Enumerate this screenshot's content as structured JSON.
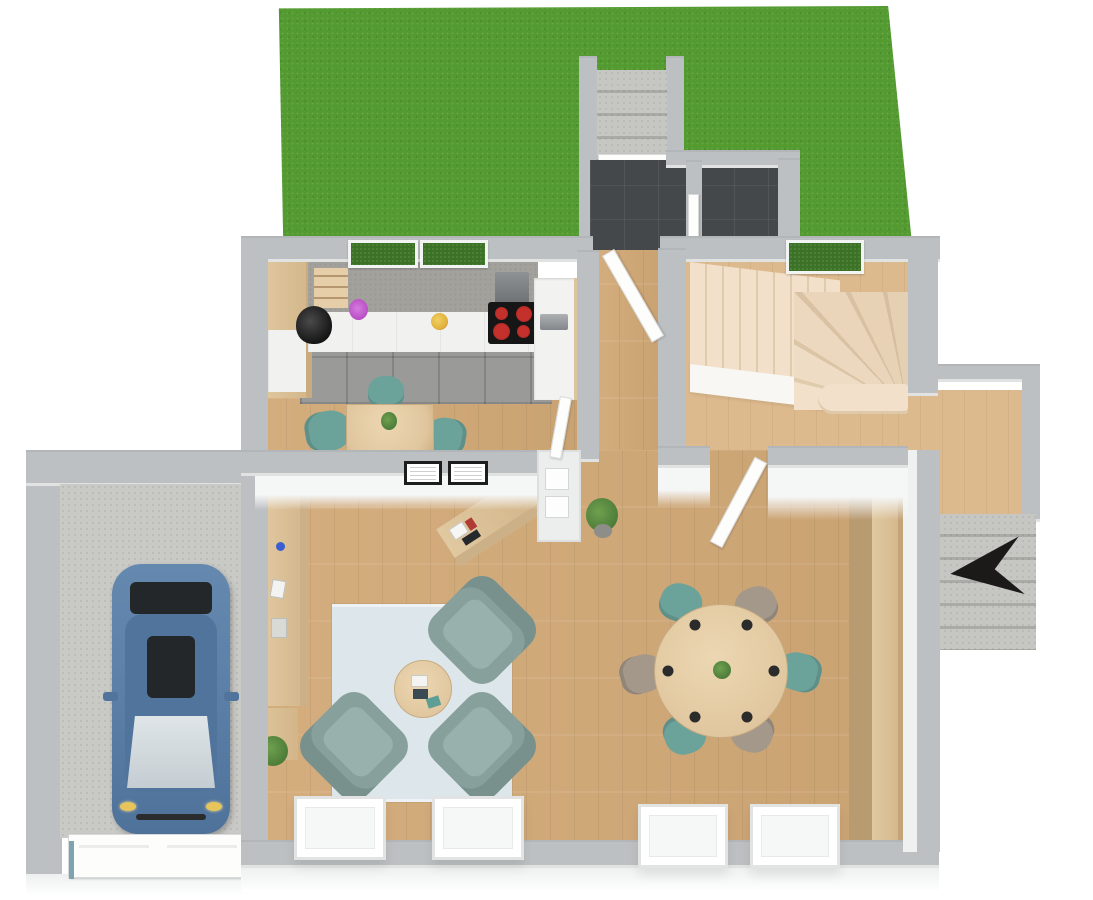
{
  "scene": {
    "description": "3D rendered top-down dollhouse view of a single-storey house floor plan with garden lawn, garage with parked car, kitchen, hallway, winder staircase, open-plan living and dining area, entry porches with exterior concrete steps and a north orientation arrow",
    "view": "top-down 3D render",
    "orientation_marker": "north-arrow"
  },
  "palette": {
    "grass": "#539b31",
    "window_grass": "#3c7226",
    "wall_top": "#bdc0c2",
    "wall_face": "#f5f6f6",
    "wood_floor": "#d2a977",
    "wood_floor_light": "#ddba8d",
    "kitchen_tile": "#9a9a98",
    "dark_tile": "#45484a",
    "concrete": "#c6c6c2",
    "garage_floor": "#c9c9c6",
    "stair_tread": "#f2e0ca",
    "stair_tread_shade": "#e0cbad",
    "counter_gray": "#a3a19c",
    "cabinet_wood": "#e0c8a0",
    "cabinet_white": "#f1f1ef",
    "table_wood": "#e0c69e",
    "armchair": "#87a09c",
    "armchair_seat": "#99b1ad",
    "chair_teal": "#6ba39b",
    "chair_taupe": "#a3988a",
    "rug_navy": "#24506c",
    "rug_mid": "#3a6f8e",
    "rug_light": "#7fa2bc",
    "rug_pale": "#a9c0d2",
    "car_body": "#5d81a8",
    "car_roof": "#51749c",
    "car_glass_light": "#c4cdd2",
    "car_glass_dark": "#24272a",
    "cooktop": "#161616",
    "burner_red": "#c4302b",
    "shelf_teal": "#5f9e94",
    "shelf_white": "#f2f2f2",
    "plant_green": "#4e7d3a",
    "flower_purple": "#b84fc4",
    "fruit_yellow": "#e0b23a",
    "north_arrow": "#1b1a19"
  },
  "rooms": [
    {
      "name": "lawn",
      "surface": "grass"
    },
    {
      "name": "entry-steps-north",
      "surface": "concrete"
    },
    {
      "name": "entry-hall",
      "surface": "dark-tile"
    },
    {
      "name": "wc",
      "surface": "dark-tile"
    },
    {
      "name": "kitchen",
      "surface": "wood + gray tile work strip"
    },
    {
      "name": "hallway",
      "surface": "wood"
    },
    {
      "name": "staircase",
      "surface": "wood winder treads"
    },
    {
      "name": "living-room",
      "surface": "wood"
    },
    {
      "name": "dining-area",
      "surface": "wood"
    },
    {
      "name": "side-porch-east",
      "surface": "wood + concrete steps"
    },
    {
      "name": "garage",
      "surface": "concrete",
      "contains": "car"
    }
  ],
  "kitchen": {
    "items": [
      "counter-with-sink",
      "range-hood",
      "cooktop-4-burners",
      "tall-oven-cabinet",
      "open-shelves",
      "purple-flower-vase",
      "yellow-fruit-bowl",
      "dining-table",
      "teal-chairs",
      "table-plant"
    ],
    "burner_count": 4
  },
  "living_room": {
    "items": [
      "patchwork-rug",
      "three-armchairs",
      "round-coffee-table",
      "books",
      "sideboard",
      "console-cabinet",
      "potted-plants",
      "tv-lowboard",
      "two-wall-frames"
    ],
    "rug_cells": [
      "rug_mid",
      "rug_light",
      "rug_mid",
      "rug_navy",
      "rug_navy",
      "rug_pale",
      "rug_navy",
      "rug_light",
      "rug_mid",
      "rug_navy",
      "rug_pale",
      "rug_navy",
      "rug_light",
      "rug_navy",
      "rug_mid",
      "rug_navy",
      "rug_navy",
      "rug_mid",
      "rug_navy",
      "rug_mid"
    ]
  },
  "dining_area": {
    "items": [
      "round-table-6-seats",
      "center-plant",
      "bookshelf-with-boxes"
    ],
    "place_settings": 6,
    "chair_colors": [
      "teal",
      "taupe",
      "taupe",
      "teal",
      "teal",
      "taupe"
    ],
    "bookshelf_segments": [
      "cabinet_wood",
      "shelf_teal",
      "shelf_white",
      "shelf_teal",
      "shelf_white",
      "cabinet_wood",
      "shelf_white",
      "shelf_teal",
      "shelf_white",
      "cabinet_wood",
      "shelf_teal",
      "shelf_white",
      "shelf_teal",
      "cabinet_wood",
      "shelf_white",
      "shelf_teal"
    ]
  },
  "garage": {
    "items": [
      "car",
      "garage-door"
    ],
    "car_color": "#5d81a8"
  }
}
